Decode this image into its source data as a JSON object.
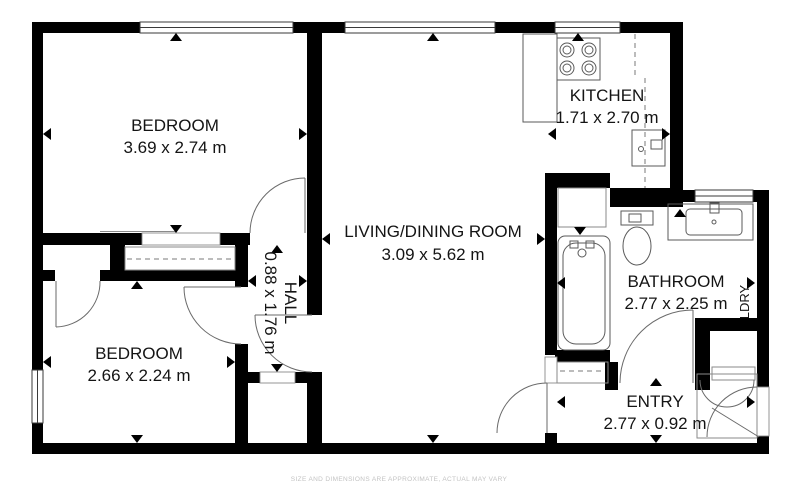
{
  "plan": {
    "disclaimer": "SIZE AND DIMENSIONS ARE APPROXIMATE, ACTUAL MAY VARY",
    "colors": {
      "wall": "#000000",
      "fixture_line": "#5a5a5a",
      "label": "#141414",
      "disclaimer": "#c3c3c3",
      "background": "#ffffff"
    },
    "rooms": [
      {
        "name": "BEDROOM",
        "dims": "3.69 x 2.74 m"
      },
      {
        "name": "LIVING/DINING ROOM",
        "dims": "3.09 x 5.62 m"
      },
      {
        "name": "KITCHEN",
        "dims": "1.71 x 2.70 m"
      },
      {
        "name": "BEDROOM",
        "dims": "2.66 x 2.24 m"
      },
      {
        "name": "HALL",
        "dims": "0.88 x 1.76 m"
      },
      {
        "name": "BATHROOM",
        "dims": "2.77 x 2.25 m"
      },
      {
        "name": "ENTRY",
        "dims": "2.77 x 0.92 m"
      },
      {
        "name": "LDRY",
        "dims": ""
      }
    ],
    "fixtures": [
      "stove-icon",
      "refrigerator-icon",
      "bathtub-icon",
      "toilet-icon",
      "sink-vanity-icon",
      "closet-sliding-doors",
      "window",
      "door-swing"
    ]
  }
}
